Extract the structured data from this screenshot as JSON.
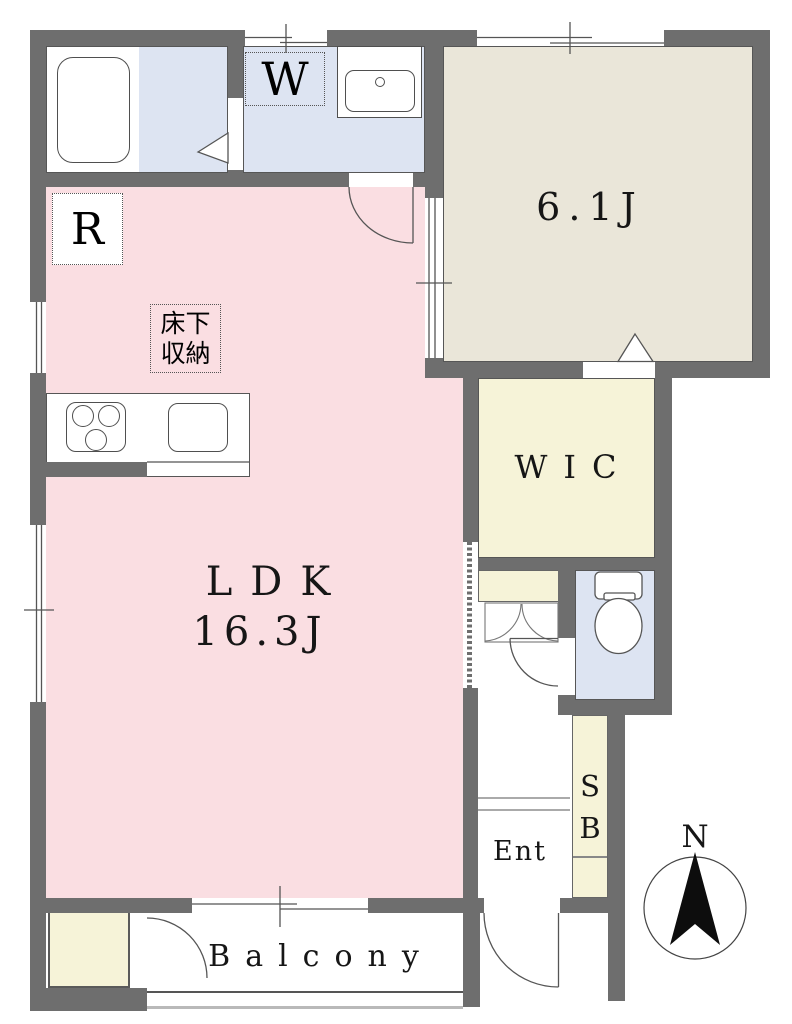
{
  "meta": {
    "type": "apartment-floor-plan"
  },
  "rooms": {
    "ldk": {
      "name": "LDK",
      "size": "16.3J"
    },
    "bedroom": {
      "size": "6.1J"
    },
    "wic": {
      "label": "WIC"
    },
    "entrance": {
      "label": "Ent"
    },
    "balcony": {
      "label": "Balcony"
    },
    "shoe_box": {
      "line1": "S",
      "line2": "B"
    }
  },
  "fixtures": {
    "washing_machine": "W",
    "refrigerator": "R",
    "underfloor_storage": {
      "line1": "床下",
      "line2": "収納"
    }
  },
  "compass": {
    "north": "N"
  },
  "colors": {
    "wall": "#6e6e6e",
    "ldk_floor": "#fadee2",
    "wet_area_floor": "#dde4f2",
    "bedroom_floor": "#eae6d9",
    "closet_floor": "#f6f3d8",
    "outline": "#565656",
    "text": "#161616"
  }
}
